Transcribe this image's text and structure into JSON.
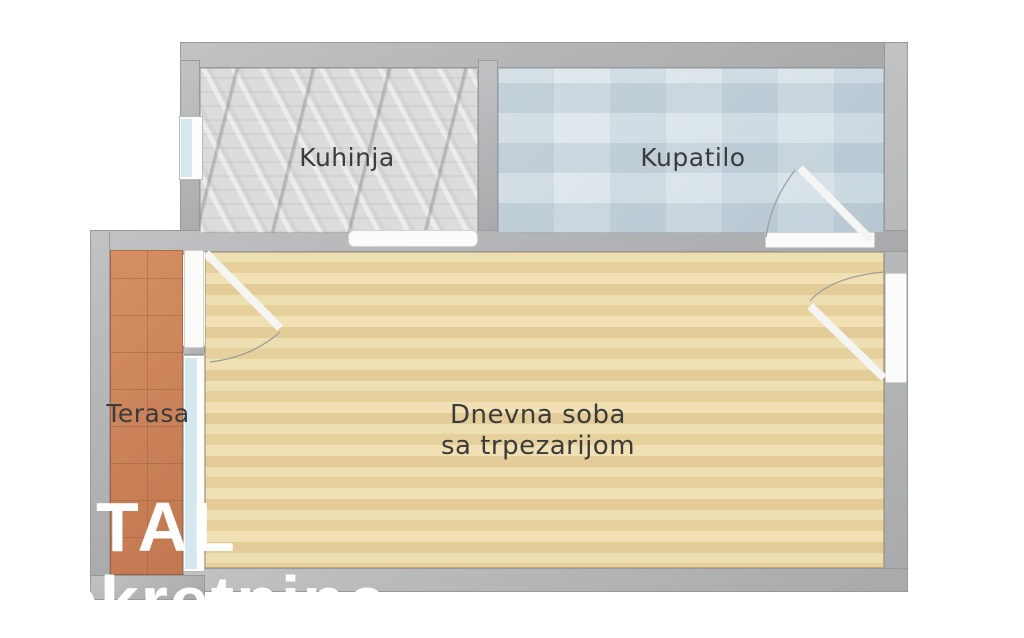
{
  "rooms": {
    "kitchen": {
      "label": "Kuhinja"
    },
    "bathroom": {
      "label": "Kupatilo"
    },
    "living_room": {
      "label_line1": "Dnevna soba",
      "label_line2": "sa trpezarijom"
    },
    "terrace": {
      "label": "Terasa"
    }
  },
  "watermark": {
    "line1": "TOTAL",
    "line2": "nekretnine"
  },
  "colors": {
    "canvas_bg": "#ffffff",
    "wall": "#b3b4b6",
    "wall_edge": "#98999b",
    "kitchen_floor": "#d8d8da",
    "bathroom_floor": "#d6e0e5",
    "living_floor": "#e9d5a5",
    "terrace_floor": "#cd8157",
    "window_pane": "#d4e8ef",
    "opening": "#fbfbf9",
    "label_text": "#3b3b3b",
    "watermark_text": "#ffffff"
  }
}
